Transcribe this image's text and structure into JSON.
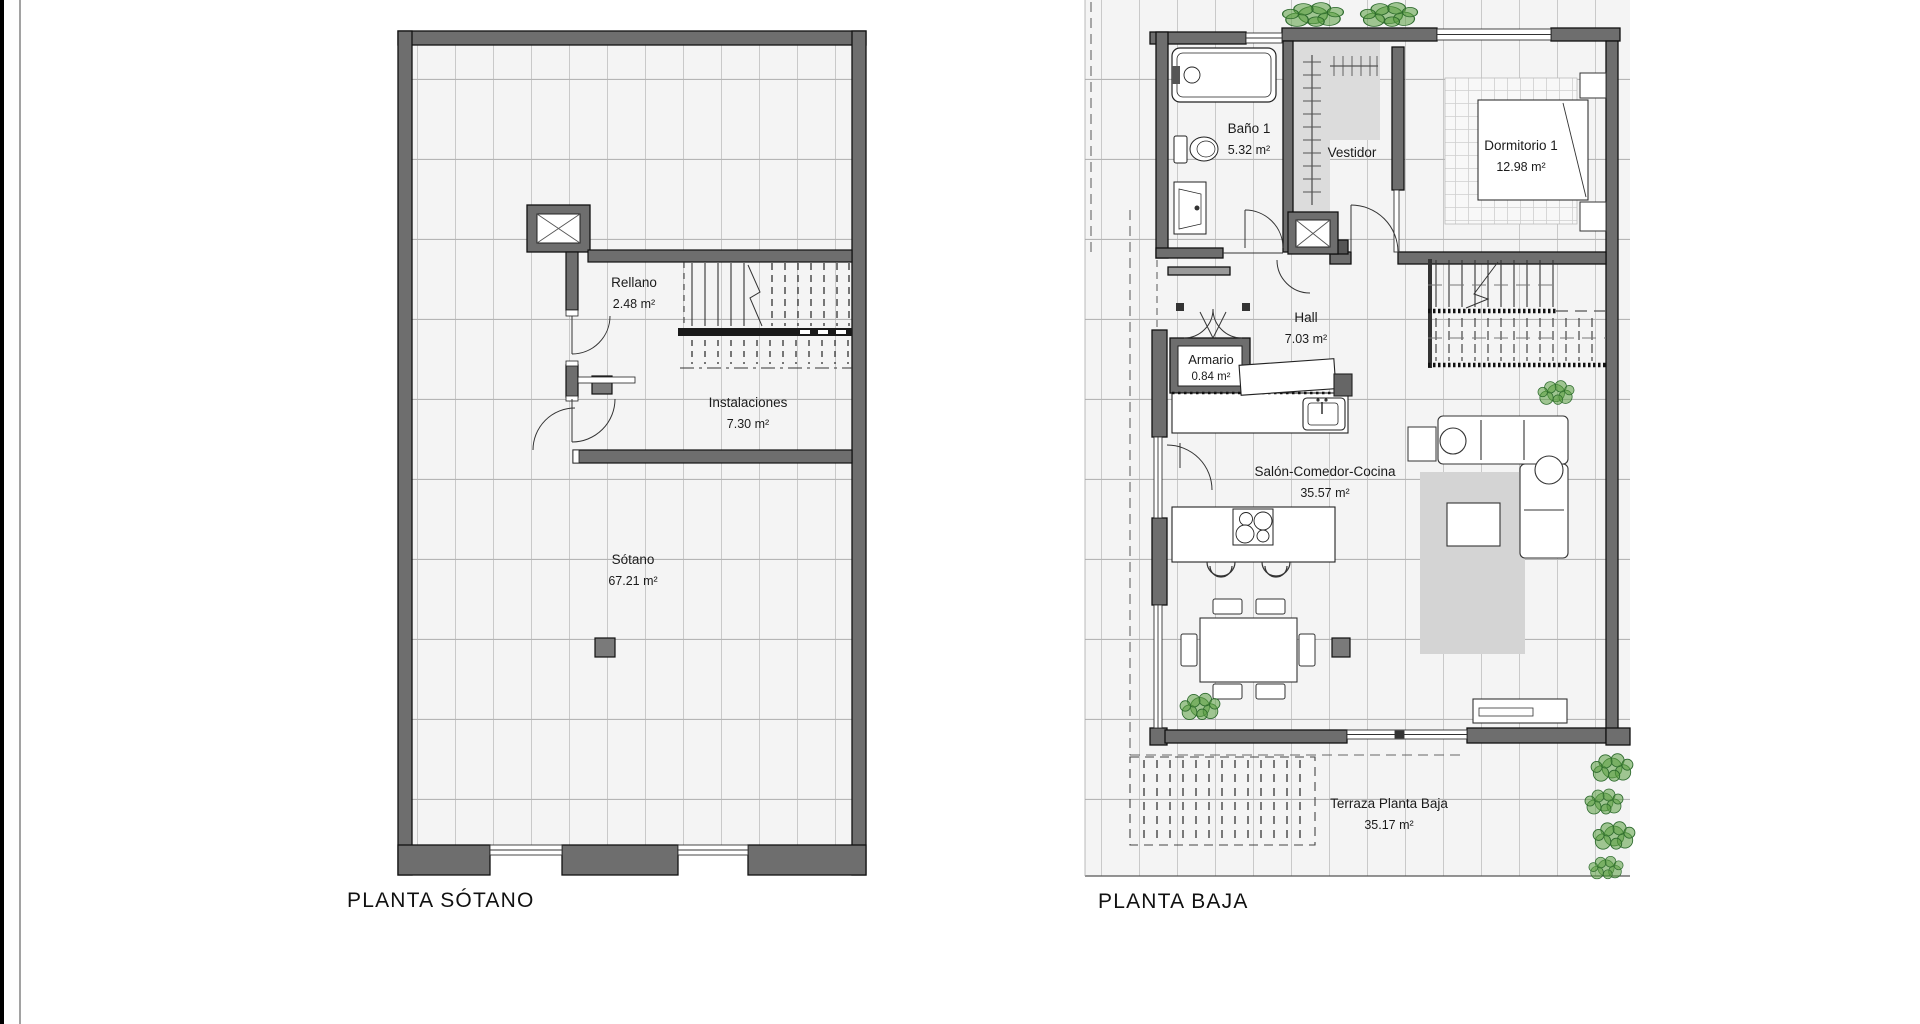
{
  "page": {
    "background": "#ffffff"
  },
  "colors": {
    "wall": "#6e6e6e",
    "wall-outline": "#111111",
    "tile-bg": "#f4f4f4",
    "grid-line": "#c9c9c9",
    "vestidor": "#dcdcdc",
    "rug": "#d4d4d4",
    "column": "#7a7a7a",
    "plant": "#5a9e3f",
    "plant-dark": "#2e6b2e",
    "label": "#1b1b1b",
    "title": "#111111"
  },
  "plans": {
    "sotano": {
      "title": "PLANTA SÓTANO",
      "rooms": {
        "rellano": {
          "name": "Rellano",
          "area": "2.48 m²"
        },
        "instalaciones": {
          "name": "Instalaciones",
          "area": "7.30 m²"
        },
        "sotano": {
          "name": "Sótano",
          "area": "67.21 m²"
        }
      }
    },
    "baja": {
      "title": "PLANTA BAJA",
      "rooms": {
        "bano1": {
          "name": "Baño 1",
          "area": "5.32 m²"
        },
        "vestidor": {
          "name": "Vestidor"
        },
        "dormitorio1": {
          "name": "Dormitorio 1",
          "area": "12.98 m²"
        },
        "hall": {
          "name": "Hall",
          "area": "7.03 m²"
        },
        "armario": {
          "name": "Armario",
          "area": "0.84 m²"
        },
        "salon": {
          "name": "Salón-Comedor-Cocina",
          "area": "35.57 m²"
        },
        "terraza": {
          "name": "Terraza Planta Baja",
          "area": "35.17 m²"
        }
      }
    }
  },
  "icons": {
    "elevator_shaft": "elevator-shaft-icon",
    "stairs": "stairs-icon",
    "bathtub": "bathtub-icon",
    "toilet": "toilet-icon",
    "washbasin": "washbasin-icon",
    "bed": "bed-icon",
    "nightstand": "nightstand-icon",
    "wardrobe_rail": "wardrobe-rail-icon",
    "kitchen_island": "kitchen-island-icon",
    "kitchen_sink": "kitchen-sink-icon",
    "cooktop": "cooktop-icon",
    "bar_stool": "bar-stool-icon",
    "dining_table": "dining-table-icon",
    "chair": "chair-icon",
    "sofa": "sofa-icon",
    "coffee_table": "coffee-table-icon",
    "side_table": "side-table-icon",
    "tv_unit": "tv-unit-icon",
    "rug": "rug-icon",
    "plant": "plant-icon",
    "column": "column-icon",
    "door": "door-arc-icon",
    "window": "window-icon",
    "pergola": "pergola-icon"
  }
}
